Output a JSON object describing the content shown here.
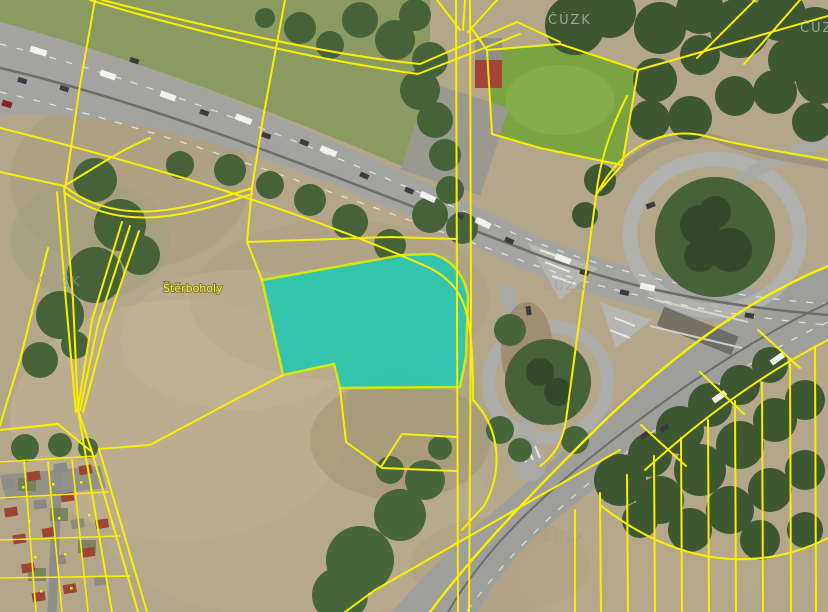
{
  "map": {
    "place_label": "Štěrboholy",
    "watermark": "ČÚZK",
    "highlight": {
      "fill": "#27c7b2",
      "border": "#d9ef00",
      "opacity": "0.9"
    },
    "cadastral_line_color": "#f8f000",
    "terrain": {
      "field": "#b3a68a",
      "trees": "#466239",
      "grass": "#8a9a60",
      "green_field": "#79a441",
      "road": "#a3a3a0"
    }
  }
}
